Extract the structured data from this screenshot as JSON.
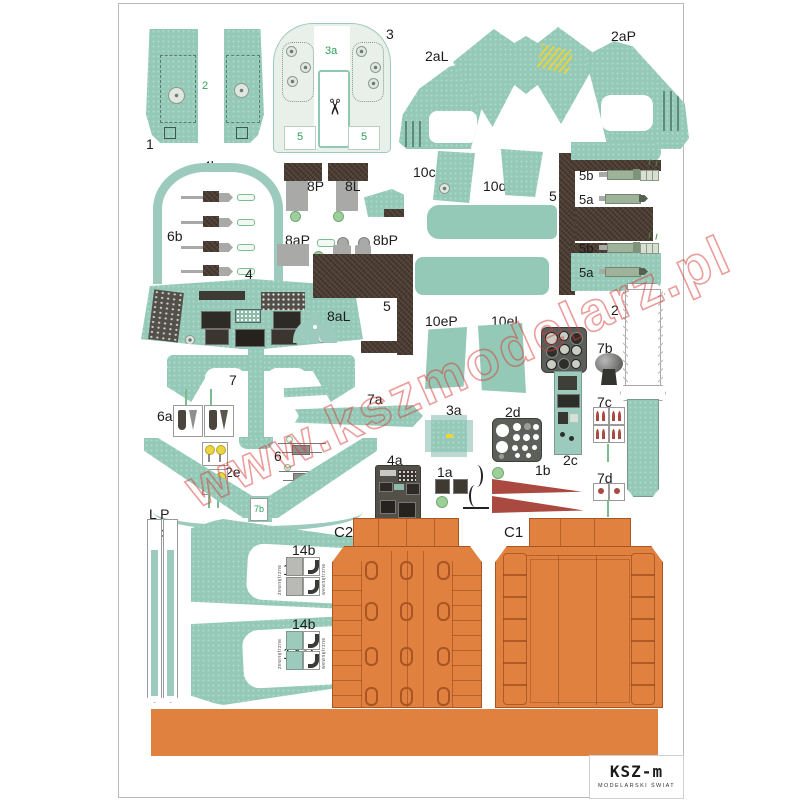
{
  "watermark": "www.kszmodelarz.pl",
  "logo": {
    "brand": "KSZ-m",
    "tagline": "MODELARSKI ŚWIAT"
  },
  "parts": {
    "p1": "1",
    "p2": "2",
    "p3": "3",
    "p3a": "3a",
    "p3_5l": "5",
    "p3_5r": "5",
    "p2aL": "2aL",
    "p2b": "2b",
    "p2aP": "2aP",
    "p4b": "4b",
    "p6b": "6b",
    "p8P": "8P",
    "p8L": "8L",
    "p8aP": "8aP",
    "p8bP": "8bP",
    "p10c": "10c",
    "p10d": "10d",
    "p5_right": "5",
    "p5b_1": "5b",
    "p5a_1": "5a",
    "p5b_2": "5b",
    "p5a_2": "5a",
    "p4": "4",
    "p8aL": "8aL",
    "p5_mid": "5",
    "p10eP": "10eP",
    "p10eL": "10eL",
    "p2_strip": "2",
    "p7b_knob": "7b",
    "p7c": "7c",
    "p7d": "7d",
    "p2c": "2c",
    "p2d": "2d",
    "p7": "7",
    "p7a": "7a",
    "p6a": "6a",
    "p3a_box": "3a",
    "p2e": "2e",
    "p6": "6",
    "p4a": "4a",
    "p1a": "1a",
    "p1b": "1b",
    "p7b_tag": "7b",
    "pLP": "L P",
    "p9b": "9b",
    "p14aP": "14aP",
    "p14aL": "14aL",
    "p14b_1": "14b",
    "p14b_2": "14b",
    "t14b_left_1": "zewnętrzne",
    "t14b_right_1": "wewnętrzne",
    "t14b_left_2": "zewnętrzne",
    "t14b_right_2": "wewnętrzne",
    "pC2": "C2",
    "pC1": "C1"
  },
  "icons": {
    "scissors": "✂"
  },
  "colors": {
    "teal": "#93c9b6",
    "dark_brown": "#493a30",
    "orange": "#e0813f",
    "red": "#a9493f",
    "yellow": "#ecd53f",
    "green_label": "#2f9e57",
    "gray": "#a9aaa7"
  }
}
